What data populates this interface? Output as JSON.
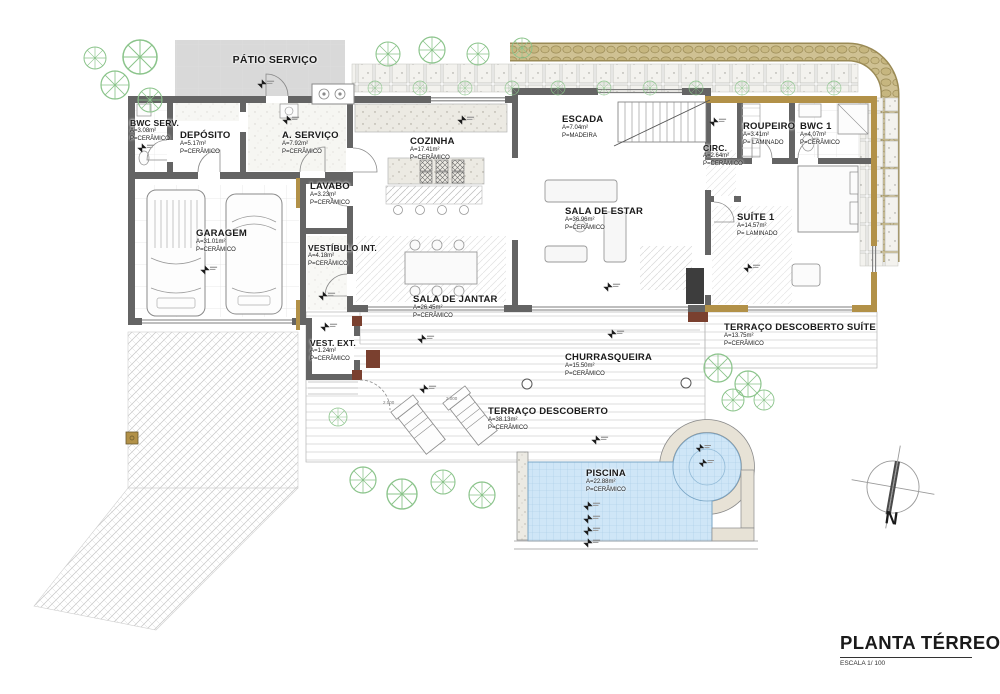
{
  "title_block": {
    "title": "PLANTA TÉRREO",
    "scale": "ESCALA 1/ 100"
  },
  "compass": {
    "label": "N"
  },
  "rooms": [
    {
      "id": "patio-servico",
      "name": "PÁTIO SERVIÇO",
      "area": "",
      "floor": ""
    },
    {
      "id": "bwc-serv",
      "name": "BWC SERV.",
      "area": "A=3.08m²",
      "floor": "P=CERÂMICO"
    },
    {
      "id": "deposito",
      "name": "DEPÓSITO",
      "area": "A=5.17m²",
      "floor": "P=CERÂMICO"
    },
    {
      "id": "a-servico",
      "name": "A. SERVIÇO",
      "area": "A=7.92m²",
      "floor": "P=CERÂMICO"
    },
    {
      "id": "cozinha",
      "name": "COZINHA",
      "area": "A=17.41m²",
      "floor": "P=CERÂMICO"
    },
    {
      "id": "escada",
      "name": "ESCADA",
      "area": "A=7.04m²",
      "floor": "P=MADEIRA"
    },
    {
      "id": "roupeiro",
      "name": "ROUPEIRO",
      "area": "A=3.41m²",
      "floor": "P= LAMINADO"
    },
    {
      "id": "bwc-1",
      "name": "BWC 1",
      "area": "A=4.07m²",
      "floor": "P=CERÂMICO"
    },
    {
      "id": "circ",
      "name": "CIRC.",
      "area": "A=2.64m²",
      "floor": "P=CERÂMICO"
    },
    {
      "id": "lavabo",
      "name": "LAVABO",
      "area": "A=3.23m²",
      "floor": "P=CERÂMICO"
    },
    {
      "id": "garagem",
      "name": "GARAGEM",
      "area": "A=31.01m²",
      "floor": "P=CERÂMICO"
    },
    {
      "id": "sala-de-estar",
      "name": "SALA DE ESTAR",
      "area": "A=36.96m²",
      "floor": "P=CERÂMICO"
    },
    {
      "id": "suite-1",
      "name": "SUÍTE  1",
      "area": "A=14.57m²",
      "floor": "P= LAMINADO"
    },
    {
      "id": "vestibulo-int",
      "name": "VESTÍBULO INT.",
      "area": "A=4.18m²",
      "floor": "P=CERÂMICO"
    },
    {
      "id": "sala-de-jantar",
      "name": "SALA DE JANTAR",
      "area": "A=26.45m²",
      "floor": "P=CERÂMICO"
    },
    {
      "id": "vest-ext",
      "name": "VEST. EXT.",
      "area": "A=1.24m²",
      "floor": "P=CERÂMICO"
    },
    {
      "id": "terraco-suite",
      "name": "TERRAÇO DESCOBERTO SUÍTE",
      "area": "A=13.75m²",
      "floor": "P=CERÂMICO"
    },
    {
      "id": "churrasqueira",
      "name": "CHURRASQUEIRA",
      "area": "A=15.50m²",
      "floor": "P=CERÂMICO"
    },
    {
      "id": "terraco-descoberto",
      "name": "TERRAÇO DESCOBERTO",
      "area": "A=38.13m²",
      "floor": "P=CERÂMICO"
    },
    {
      "id": "piscina",
      "name": "PISCINA",
      "area": "A=22.88m²",
      "floor": "P=CERÂMICO"
    }
  ],
  "annotations": {
    "chair_dims": [
      "2.000",
      "2.000"
    ]
  },
  "colors": {
    "wall_gray": "#646464",
    "wall_tan": "#b29148",
    "stone_band": "#cfc193",
    "pool_water": "#cfe6f7",
    "patio_gray": "#d9d9d9",
    "tree_green": "#8bc48b",
    "accent_brown": "#7a402f"
  }
}
